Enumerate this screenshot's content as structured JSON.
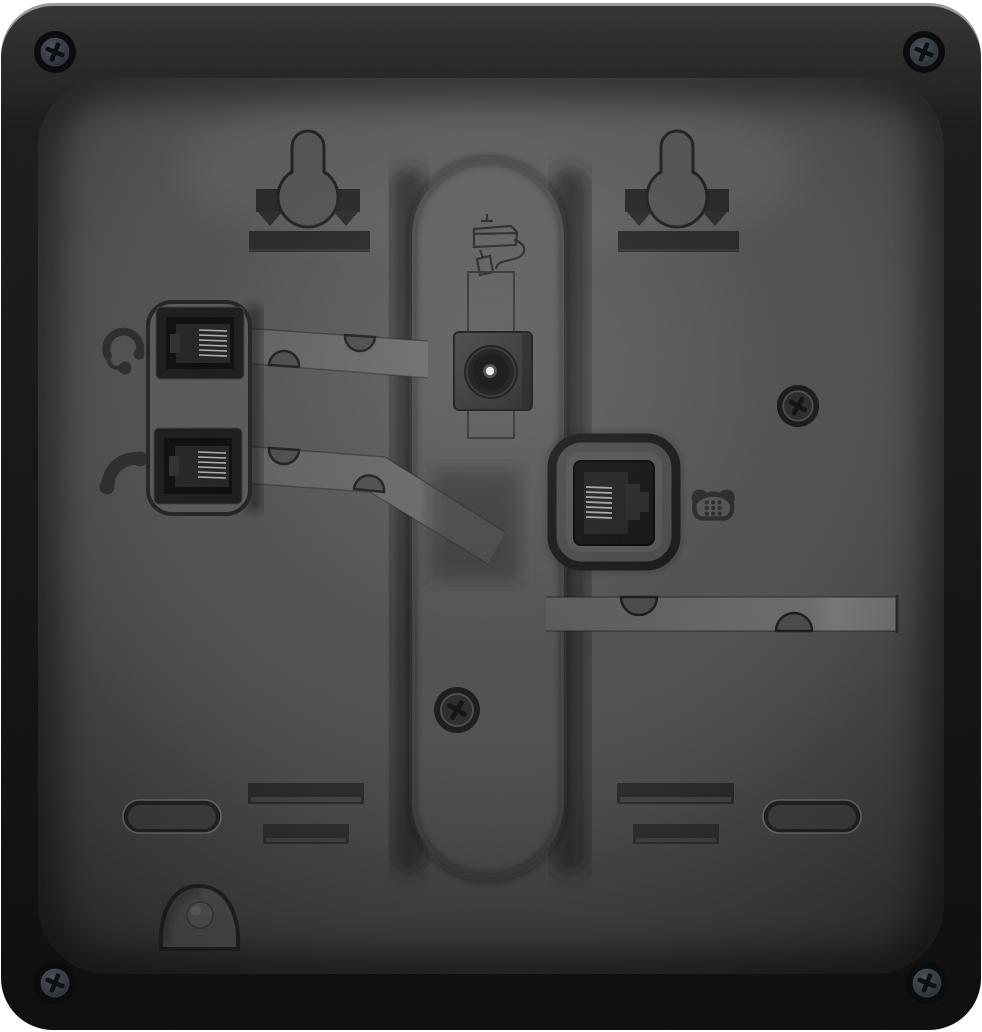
{
  "image": {
    "description": "Rear panel of a black desk IP phone",
    "colors": {
      "background": "#ffffff",
      "body": "#161616",
      "panel": "#4a4a4a",
      "channel": "#606060",
      "slot": "#262626",
      "pin_metal": "#c8c8c8",
      "screw_head": "#3a414b"
    }
  },
  "components": {
    "device_body": {
      "label": "Phone rear housing"
    },
    "back_panel": {
      "label": "Recessed back panel"
    },
    "wall_mount_left": {
      "label": "Left wall-mount keyhole slot"
    },
    "wall_mount_right": {
      "label": "Right wall-mount keyhole slot"
    },
    "headset_port": {
      "label": "Headset jack (RJ9)",
      "icon": "headset-icon"
    },
    "handset_port": {
      "label": "Handset jack (RJ9)",
      "icon": "handset-icon"
    },
    "power_jack": {
      "label": "DC power jack",
      "icon": "power-adapter-icon"
    },
    "line_port": {
      "label": "Telephone line jack (RJ11)",
      "icon": "telephone-icon"
    },
    "stand_column": {
      "label": "Central stand channel"
    },
    "cable_channel_upper": {
      "label": "Headset cable routing channel"
    },
    "cable_channel_lower": {
      "label": "Handset cable routing channel"
    },
    "cable_channel_right": {
      "label": "Line cable routing channel"
    },
    "screws": {
      "label": "Phillips screws",
      "count": 6
    },
    "stand_slots": {
      "label": "Stand mounting slots",
      "count": 4
    },
    "foot_recesses": {
      "label": "Foot recesses",
      "count": 2
    },
    "hook_recess": {
      "label": "Wall-mount hook recess"
    }
  }
}
